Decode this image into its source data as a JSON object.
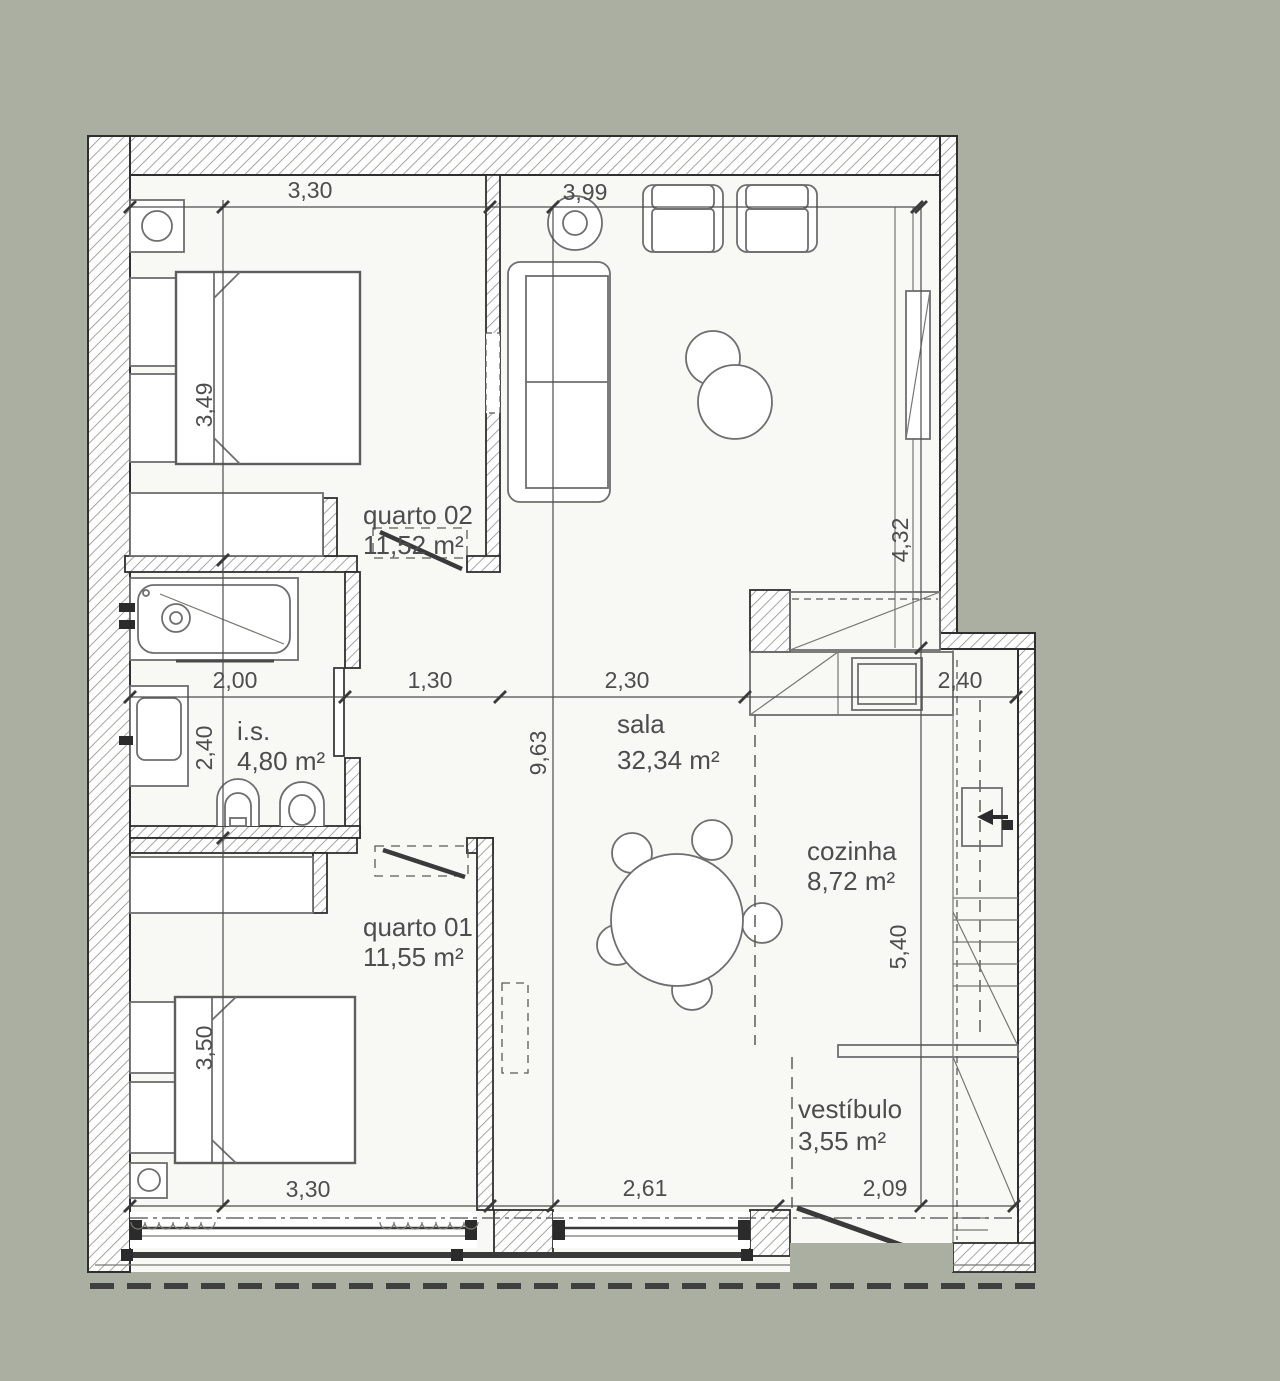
{
  "colors": {
    "background": "#ABAFA2",
    "paper": "#F8F8F5",
    "wall_line": "#2F2F2F",
    "furniture_line": "#6E6E6E",
    "text": "#4D4D4D"
  },
  "rooms": [
    {
      "name": "quarto 02",
      "area": "11,52 m²"
    },
    {
      "name": "sala",
      "area": "32,34 m²"
    },
    {
      "name": "i.s.",
      "area": "4,80 m²"
    },
    {
      "name": "cozinha",
      "area": "8,72 m²"
    },
    {
      "name": "quarto 01",
      "area": "11,55 m²"
    },
    {
      "name": "vestíbulo",
      "area": "3,55 m²"
    }
  ],
  "dimensions": {
    "top_quarto02_width": "3,30",
    "top_sala_width": "3,99",
    "quarto02_height": "3,49",
    "sala_right_height": "4,32",
    "bath_width": "2,00",
    "hall_width": "1,30",
    "sala_width": "2,30",
    "cozinha_width": "2,40",
    "bath_height": "2,40",
    "sala_height": "9,63",
    "cozinha_height": "5,40",
    "quarto01_height": "3,50",
    "bottom_quarto01_width": "3,30",
    "bottom_sala_width": "2,61",
    "bottom_vestibulo_width": "2,09"
  }
}
